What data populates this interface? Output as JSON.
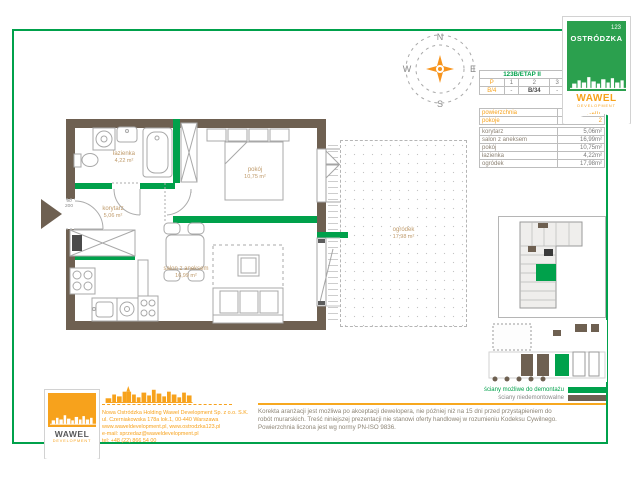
{
  "badge": {
    "number": "123",
    "street": "OSTRÓDZKA",
    "brand": "WAWEL",
    "sub": "DEVELOPMENT"
  },
  "compass": {
    "n": "N",
    "e": "E",
    "s": "S",
    "w": "W"
  },
  "unit_table": {
    "title": "123B/ETAP II",
    "floors": [
      "P",
      "1",
      "2",
      "3"
    ],
    "units": [
      "B/4",
      "-",
      "B/34",
      "-"
    ]
  },
  "summary": {
    "rows": [
      {
        "label": "powierzchnia",
        "value": "37,02m²"
      },
      {
        "label": "pokoje",
        "value": "2"
      }
    ]
  },
  "areas": {
    "rows": [
      {
        "label": "korytarz",
        "value": "5,06m²"
      },
      {
        "label": "salon z aneksem",
        "value": "16,99m²"
      },
      {
        "label": "pokój",
        "value": "10,75m²"
      },
      {
        "label": "łazienka",
        "value": "4,22m²"
      },
      {
        "label": "ogródek",
        "value": "17,98m²"
      }
    ]
  },
  "plan": {
    "rooms": {
      "lazienka": {
        "name": "łazienka",
        "area": "4,22 m²"
      },
      "korytarz": {
        "name": "korytarz",
        "area": "5,06 m²"
      },
      "pokoj": {
        "name": "pokój",
        "area": "10,75 m²"
      },
      "salon": {
        "name": "salon z aneksem",
        "area": "16,99 m²"
      },
      "ogrodek": {
        "name": "ogródek",
        "area": "17,98 m²"
      }
    },
    "entrance_door": {
      "width": "90",
      "height": "200"
    }
  },
  "legend": {
    "demountable": "ściany możliwe do demontażu",
    "permanent": "ściany niedemontowalne"
  },
  "footer": {
    "brand": "WAWEL",
    "sub": "DEVELOPMENT",
    "contact": [
      "Nowa Ostródzka Holding Wawel Development Sp. z o.o. S.K.",
      "ul. Czerniakowska 178a lok.1, 00-440 Warszawa",
      "www.waweldevelopment.pl, www.ostrodzka123.pl",
      "e-mail: sprzedaz@waweldevelopment.pl",
      "tel: +48 (22) 866 54 00"
    ],
    "disclaimer": [
      "Korekta aranżacji jest możliwa po akceptacji dewelopera, nie później niż na 15 dni przed przystąpieniem do",
      "robót murarskich. Treść niniejszej prezentacji nie stanowi oferty handlowej w rozumieniu Kodeksu Cywilnego.",
      "Powierzchnia liczona jest wg normy PN-ISO 9836."
    ]
  },
  "colors": {
    "green": "#00a14b",
    "brown": "#6e6051",
    "orange": "#f7a21c"
  }
}
